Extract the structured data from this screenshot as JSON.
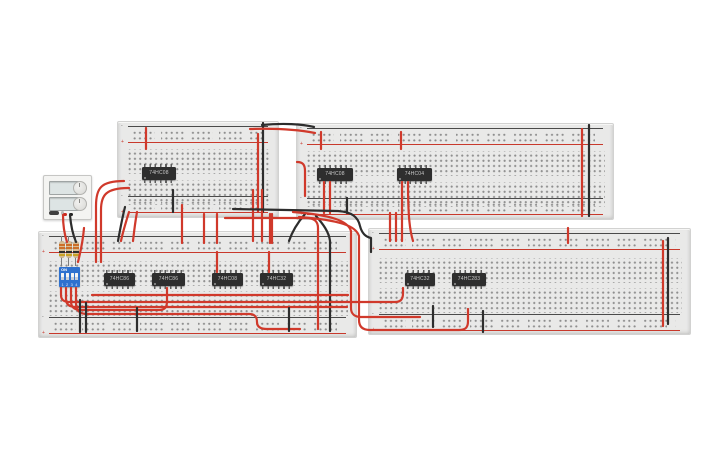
{
  "canvas": {
    "width": 725,
    "height": 453,
    "background": "#ffffff"
  },
  "colors": {
    "wire_red": "#d0392b",
    "wire_black": "#2d2d2d",
    "board_body": "#e9e9e8",
    "board_hole": "#8e8e8e",
    "rail_plus": "#c8392c",
    "rail_minus": "#4a4a4a",
    "ic_body": "#2e2e2e",
    "ic_label": "#c9c9c9",
    "dip_body": "#2e71cf",
    "resistor_body": "#d8bd93",
    "psu_body": "#f4f4f2",
    "terminal_red": "#cc2a1e",
    "terminal_black": "#222222"
  },
  "board_glyphs": {
    "plus": "+",
    "minus": "-"
  },
  "boards": [
    {
      "id": "breadboard-top-left",
      "x": 117,
      "y": 121,
      "w": 160,
      "h": 95,
      "chips": [
        {
          "label": "74HC08",
          "x": 142,
          "y": 167,
          "w": 34,
          "h": 13
        }
      ]
    },
    {
      "id": "breadboard-top-right",
      "x": 296,
      "y": 123,
      "w": 316,
      "h": 95,
      "chips": [
        {
          "label": "74HC08",
          "x": 317,
          "y": 168,
          "w": 36,
          "h": 13
        },
        {
          "label": "74HC04",
          "x": 397,
          "y": 168,
          "w": 35,
          "h": 13
        }
      ]
    },
    {
      "id": "breadboard-bottom-left",
      "x": 38,
      "y": 231,
      "w": 317,
      "h": 105,
      "chips": [
        {
          "label": "74HC86",
          "x": 104,
          "y": 273,
          "w": 31,
          "h": 13
        },
        {
          "label": "74HC86",
          "x": 152,
          "y": 273,
          "w": 33,
          "h": 13
        },
        {
          "label": "74HC08",
          "x": 212,
          "y": 273,
          "w": 31,
          "h": 13
        },
        {
          "label": "74HC32",
          "x": 260,
          "y": 273,
          "w": 33,
          "h": 13
        }
      ]
    },
    {
      "id": "breadboard-bottom-right",
      "x": 368,
      "y": 228,
      "w": 321,
      "h": 105,
      "chips": [
        {
          "label": "74HC32",
          "x": 405,
          "y": 273,
          "w": 30,
          "h": 13
        },
        {
          "label": "74HC283",
          "x": 452,
          "y": 273,
          "w": 34,
          "h": 13
        }
      ]
    }
  ],
  "power_supply": {
    "x": 43,
    "y": 175,
    "w": 47,
    "h": 43,
    "displays": [
      {
        "top": 5
      },
      {
        "top": 21
      }
    ],
    "knobs": [
      {
        "top": 5
      },
      {
        "top": 21
      }
    ],
    "terminals": [
      {
        "color": "red",
        "left": 19,
        "top": 36.5
      },
      {
        "color": "black",
        "left": 25,
        "top": 36.5
      }
    ]
  },
  "dip_switch": {
    "x": 59,
    "y": 267,
    "w": 21,
    "h": 20,
    "on_label": "ON",
    "numbers": "1234",
    "switch_lefts": [
      2.2,
      6.9,
      11.6,
      16.3
    ]
  },
  "resistors": [
    {
      "x": 58,
      "y": 236,
      "h": 30,
      "bands": [
        "#cc6f2a",
        "#cc6f2a",
        "#2e2e2e",
        "#c9a227"
      ]
    },
    {
      "x": 65,
      "y": 236,
      "h": 30,
      "bands": [
        "#cc6f2a",
        "#cc6f2a",
        "#2e2e2e",
        "#c9a227"
      ]
    },
    {
      "x": 72,
      "y": 236,
      "h": 30,
      "bands": [
        "#cc6f2a",
        "#cc6f2a",
        "#2e2e2e",
        "#c9a227"
      ]
    }
  ],
  "wires": [
    {
      "color": "red",
      "d": "M63,215 C63,226 64,233 67,242"
    },
    {
      "color": "black",
      "d": "M70,215 C71,227 73,235 76,242"
    },
    {
      "color": "red",
      "d": "M124,181 C101,181 96,188 96,206 L96,262"
    },
    {
      "color": "red",
      "d": "M129,188 C106,188 101,195 101,210 L101,262"
    },
    {
      "color": "red",
      "d": "M146,128 L146,149"
    },
    {
      "color": "red",
      "d": "M258,134 L258,212"
    },
    {
      "color": "black",
      "d": "M263,123 L263,212"
    },
    {
      "color": "red",
      "d": "M250,129 C278,128 300,130 315,133"
    },
    {
      "color": "black",
      "d": "M262,125 C283,123 302,124 314,127"
    },
    {
      "color": "red",
      "d": "M297,162 C303,162 305,165 305,171 L305,196"
    },
    {
      "color": "red",
      "d": "M324,182 L324,213"
    },
    {
      "color": "red",
      "d": "M330,182 L330,213"
    },
    {
      "color": "red",
      "d": "M321,132 L321,149"
    },
    {
      "color": "red",
      "d": "M401,132 L401,149"
    },
    {
      "color": "red",
      "d": "M402,182 L402,241"
    },
    {
      "color": "red",
      "d": "M408,182 C408,218 410,231 413,241"
    },
    {
      "color": "red",
      "d": "M396,213 L396,241"
    },
    {
      "color": "red",
      "d": "M390,213 L390,241"
    },
    {
      "color": "black",
      "d": "M347,198 L347,213"
    },
    {
      "color": "red",
      "d": "M582,129 L582,216"
    },
    {
      "color": "black",
      "d": "M589,125 L589,216"
    },
    {
      "color": "red",
      "d": "M663,241 L663,326"
    },
    {
      "color": "black",
      "d": "M668,238 L668,324"
    },
    {
      "color": "red",
      "d": "M568,228 L568,243"
    },
    {
      "color": "black",
      "d": "M173,190 L173,212"
    },
    {
      "color": "black",
      "d": "M125,207 C122,219 120,230 118,241"
    },
    {
      "color": "red",
      "d": "M129,212 C126,222 123,231 121,241"
    },
    {
      "color": "red",
      "d": "M137,212 C135,223 134,232 133,241"
    },
    {
      "color": "red",
      "d": "M182,205 L182,243"
    },
    {
      "color": "red",
      "d": "M204,214 L204,243"
    },
    {
      "color": "red",
      "d": "M217,214 L217,243"
    },
    {
      "color": "red",
      "d": "M270,214 L270,243"
    },
    {
      "color": "red",
      "d": "M217,252 L217,272"
    },
    {
      "color": "red",
      "d": "M269,252 L269,272"
    },
    {
      "color": "red",
      "d": "M253,190 L253,241"
    },
    {
      "color": "red",
      "d": "M262,190 L262,241"
    },
    {
      "color": "red",
      "d": "M272,214 L272,243"
    },
    {
      "color": "black",
      "d": "M233,209 L338,211 C352,212 358,217 360,226 C362,234 366,237 371,238 L371,252"
    },
    {
      "color": "black",
      "d": "M305,214 C299,221 293,229 289,241"
    },
    {
      "color": "black",
      "d": "M316,216 C323,224 329,232 330,241 L330,331"
    },
    {
      "color": "red",
      "d": "M225,218 L306,218 C314,218 318,221 318,228 L318,329"
    },
    {
      "color": "red",
      "d": "M293,212 C332,215 348,221 351,231 L351,308 C351,314 355,317 361,317 L420,317"
    },
    {
      "color": "red",
      "d": "M299,217 C340,220 356,226 359,236 L359,320 C359,327 363,330 370,330 L459,330 C466,330 468,327 468,321 L468,309"
    },
    {
      "color": "red",
      "d": "M61,288 L61,295 C61,300 64,302 70,302 L395,302 C401,302 403,299 403,293 L403,288"
    },
    {
      "color": "red",
      "d": "M66,288 L66,299 C66,305 70,307 76,307 L347,307"
    },
    {
      "color": "red",
      "d": "M71,288 L71,301 C71,308 75,310 81,310 L159,310 C165,310 167,307 167,301 L167,288"
    },
    {
      "color": "red",
      "d": "M76,288 L76,303 C76,312 81,314 87,314 L249,314 C255,314 257,317 257,322 C257,327 261,329 267,329 L300,329"
    },
    {
      "color": "red",
      "d": "M84,228 C83,240 81,250 78,262"
    },
    {
      "color": "red",
      "d": "M92,295 L348,295"
    },
    {
      "color": "black",
      "d": "M80,300 L80,332"
    },
    {
      "color": "black",
      "d": "M86,303 L86,332"
    },
    {
      "color": "black",
      "d": "M137,308 L137,331"
    },
    {
      "color": "black",
      "d": "M289,308 L289,331"
    },
    {
      "color": "black",
      "d": "M433,306 L433,327"
    },
    {
      "color": "black",
      "d": "M483,311 L483,332"
    }
  ]
}
